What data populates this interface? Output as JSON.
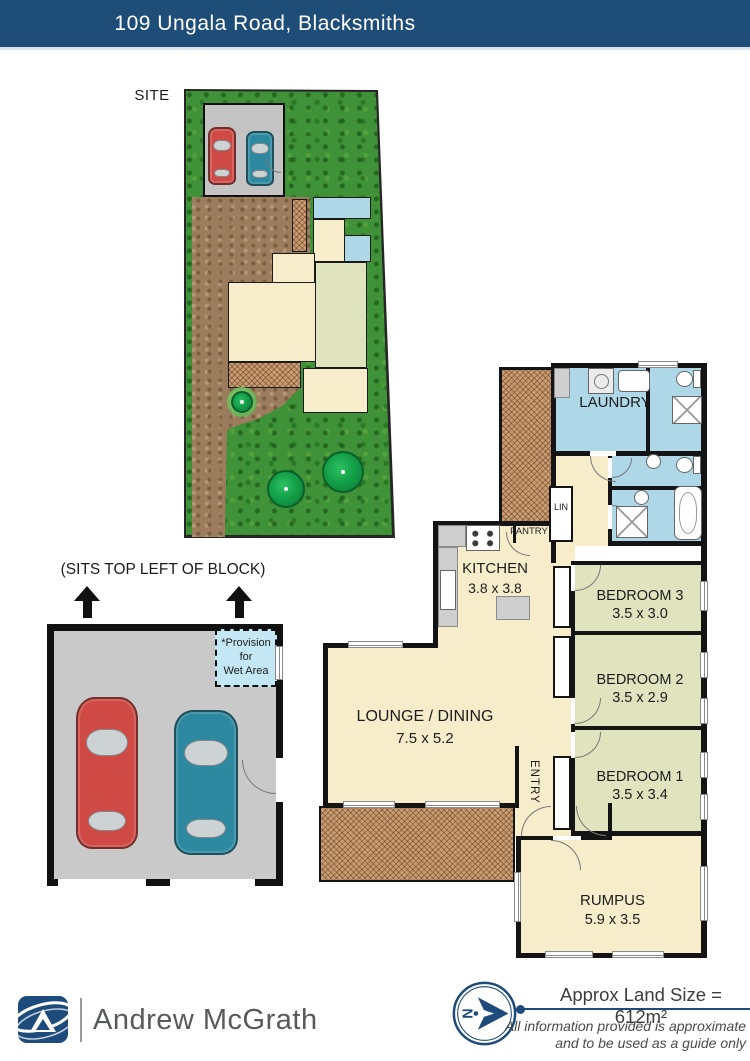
{
  "header": {
    "title": "109 Ungala Road, Blacksmiths"
  },
  "site_plan": {
    "label": "SITE"
  },
  "garage_plan": {
    "note": "(SITS TOP LEFT OF BLOCK)",
    "wet_area": {
      "line1": "*Provision",
      "line2": "for",
      "line3": "Wet Area"
    }
  },
  "floor_plan": {
    "laundry": {
      "name": "LAUNDRY"
    },
    "kitchen": {
      "name": "KITCHEN",
      "dims": "3.8 x 3.8"
    },
    "pantry": {
      "name": "PANTRY"
    },
    "linen": {
      "name": "LIN"
    },
    "bedroom3": {
      "name": "BEDROOM 3",
      "dims": "3.5 x 3.0"
    },
    "bedroom2": {
      "name": "BEDROOM 2",
      "dims": "3.5 x 2.9"
    },
    "bedroom1": {
      "name": "BEDROOM 1",
      "dims": "3.5 x 3.4"
    },
    "lounge_dining": {
      "name": "LOUNGE / DINING",
      "dims": "7.5 x 5.2"
    },
    "entry": {
      "name": "ENTRY"
    },
    "rumpus": {
      "name": "RUMPUS",
      "dims": "5.9 x 3.5"
    }
  },
  "footer": {
    "brand": "Andrew McGrath",
    "land_size": "Approx Land Size = 612m²",
    "disclaimer_line1": "All information provided is approximate",
    "disclaimer_line2": "and to be used as a guide only"
  },
  "colors": {
    "header_bar": "#1E4D78",
    "brand_blue": "#1D4B7B",
    "room_cream": "#F7EDCB",
    "bedroom_green": "#E0E4BE",
    "wet_area_blue": "#AED7E8",
    "deck_brown": "#C89D74",
    "grass_green": "#3F9237",
    "dirt_brown": "#9B7C5C",
    "wall_black": "#141414",
    "car_red": "#D04A45",
    "car_teal": "#2C89A0"
  }
}
